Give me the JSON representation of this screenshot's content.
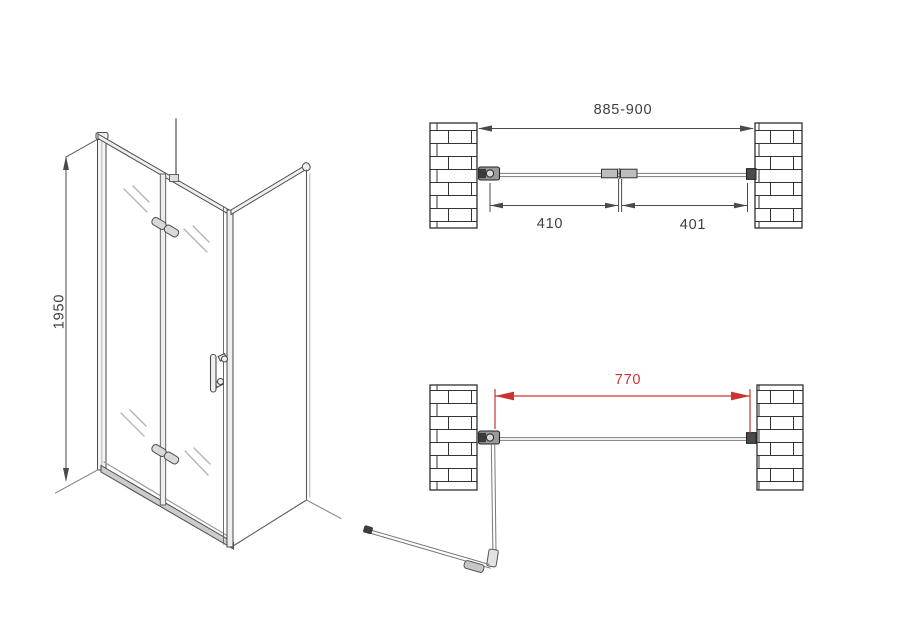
{
  "drawing": {
    "front_view": {
      "height_dimension_label": "1950"
    },
    "plan_view_closed": {
      "overall_width_label": "885-900",
      "door_panel_width_label": "410",
      "fixed_panel_width_label": "401"
    },
    "plan_view_open": {
      "opening_width_label": "770"
    },
    "colors": {
      "line": "#3c3c3c",
      "glass_gray": "#8a8a8a",
      "dimension_red": "#cc3333",
      "background": "#ffffff"
    }
  }
}
